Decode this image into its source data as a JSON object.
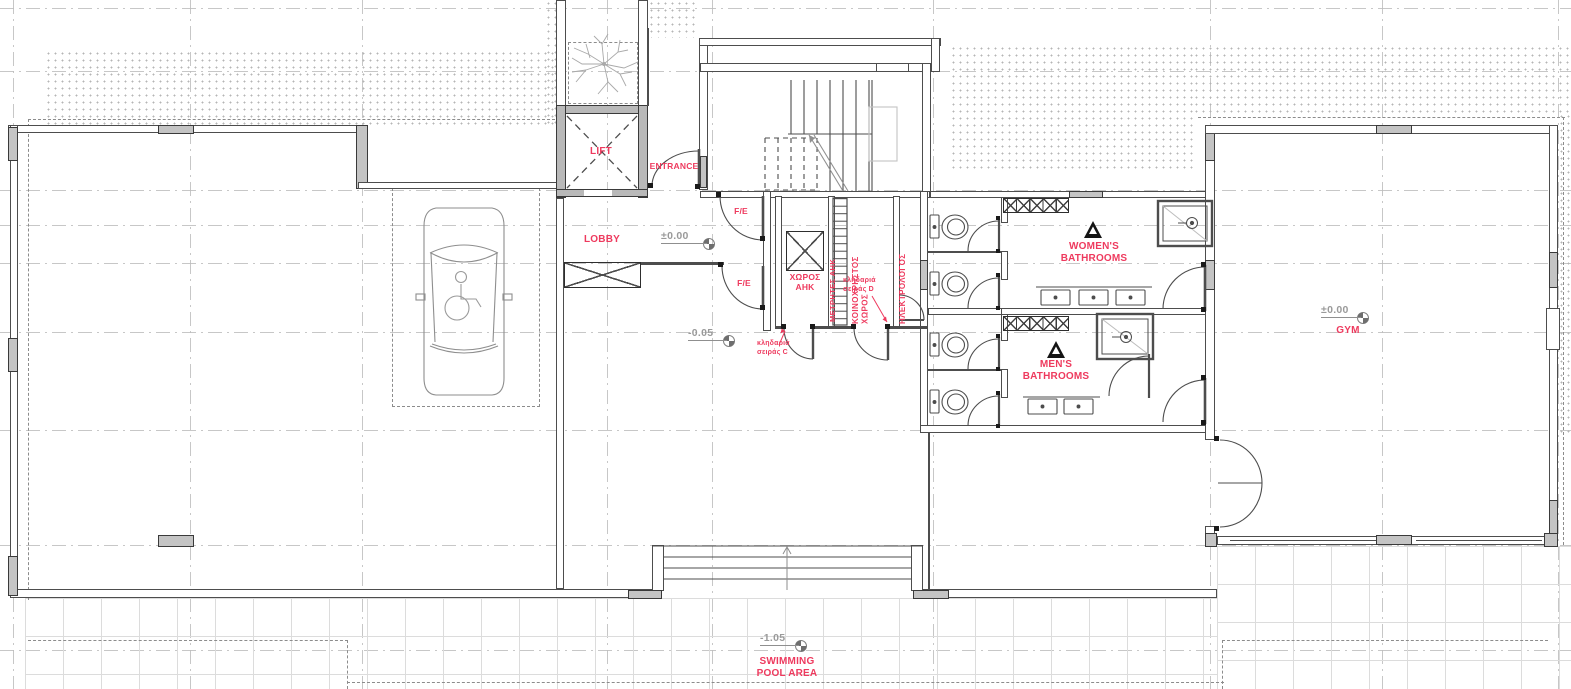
{
  "colors": {
    "label": "#ee3a5e",
    "level_text": "#9a9a9a"
  },
  "labels": {
    "lift": "LIFT",
    "entrance": "ENTRANCE",
    "lobby": "LOBBY",
    "fe_upper": "F/E",
    "fe_lower": "F/E",
    "ahk_room": "ΧΩΡΟΣ\nΑΗΚ",
    "ahk_meters": "ΜΕΤΡΗΤΕΣ ΑΗΚ",
    "common_room": "ΚΟΙΝΟΧΡΗΣΤΟΣ\nΧΩΡΟΣ",
    "electrical": "ΗΛΕΚΤΡΟΛΟΓΟΣ",
    "womens_bathrooms": "WOMEN'S\nBATHROOMS",
    "mens_bathrooms": "MEN'S\nBATHROOMS",
    "gym": "GYM",
    "swimming_pool": "SWIMMING\nPOOL AREA",
    "lock_c": "κληδαριά\nσειράς C",
    "lock_d": "κληδαριά\nσειράς D"
  },
  "levels": {
    "lobby": "±0.00",
    "south_area": "-0.05",
    "gym": "±0.00",
    "pool": "-1.05"
  }
}
